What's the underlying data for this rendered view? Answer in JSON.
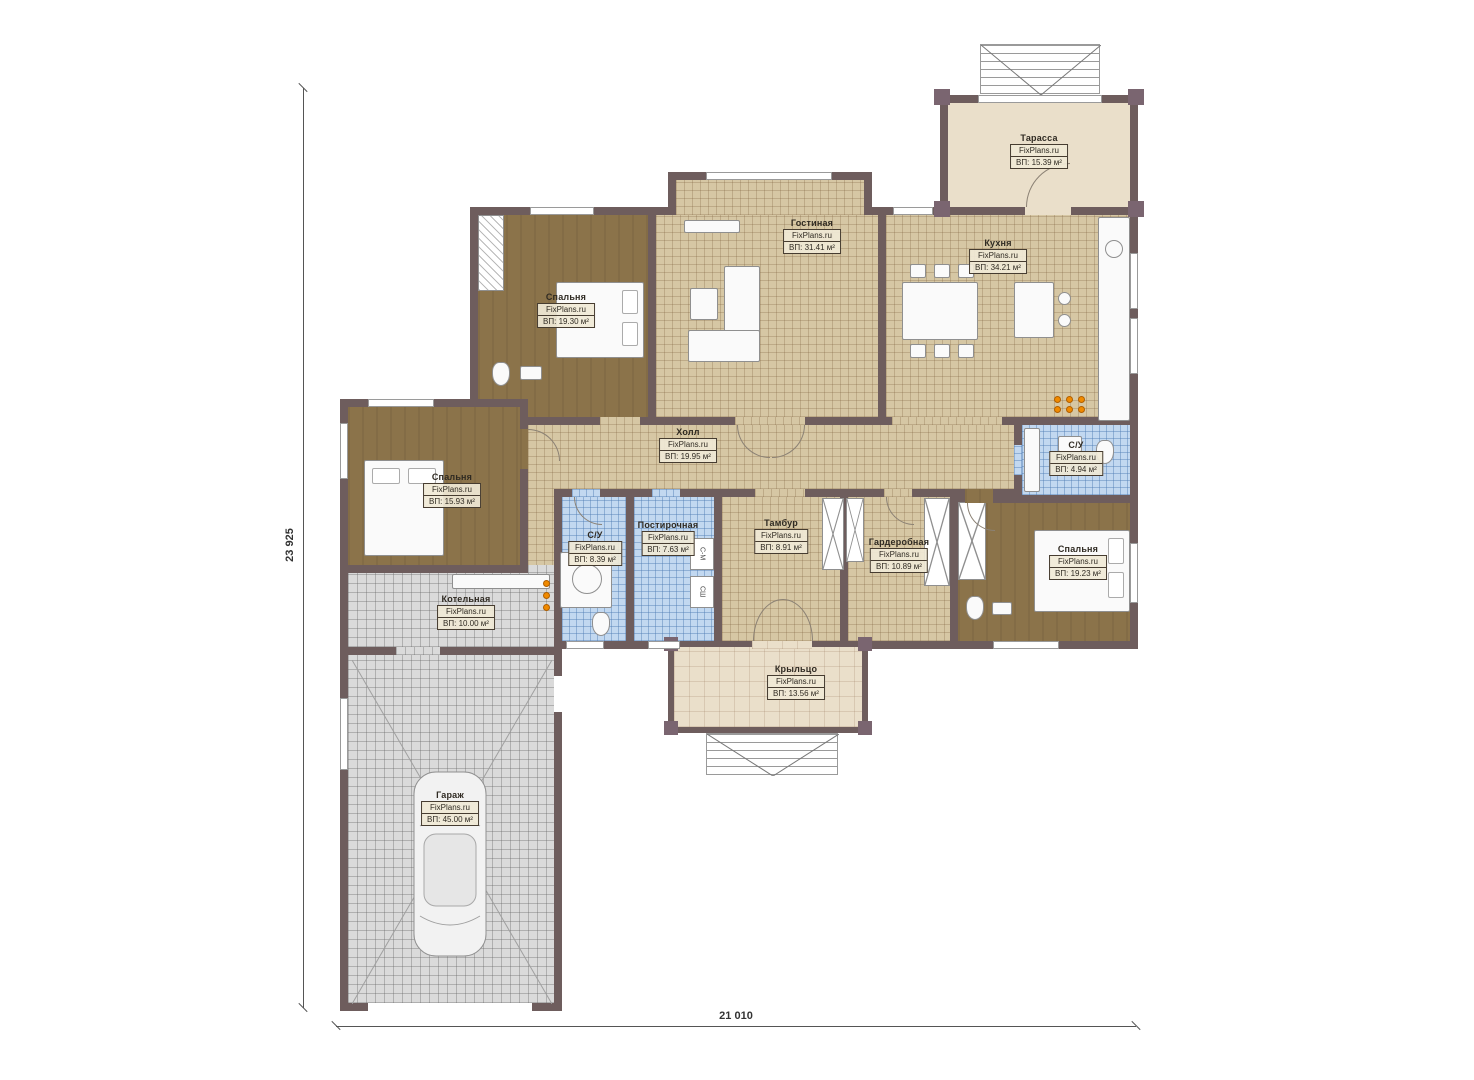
{
  "plan": {
    "watermark": "FixPlans.ru",
    "dim_width": "21 010",
    "dim_height": "23 925",
    "washer_label": "С-М",
    "dryer_label": "СШ",
    "colors": {
      "wall": "#6e5d5d",
      "tile_beige": "#d6c7a4",
      "floor_brown": "#8b734a",
      "tile_blue": "#c2d8f0",
      "tile_gray": "#dadada",
      "plain_beige": "#eadfca",
      "accent_orange": "#f08a00"
    }
  },
  "rooms": [
    {
      "id": "terrace",
      "name": "Тарасса",
      "area": "ВП: 15.39 м²"
    },
    {
      "id": "living",
      "name": "Гостиная",
      "area": "ВП: 31.41 м²"
    },
    {
      "id": "kitchen",
      "name": "Кухня",
      "area": "ВП: 34.21 м²"
    },
    {
      "id": "bedroom-top",
      "name": "Спальня",
      "area": "ВП: 19.30 м²"
    },
    {
      "id": "hall",
      "name": "Холл",
      "area": "ВП: 19.95 м²"
    },
    {
      "id": "bedroom-left",
      "name": "Спальня",
      "area": "ВП: 15.93 м²"
    },
    {
      "id": "bathroom-left",
      "name": "С/У",
      "area": "ВП: 8.39 м²"
    },
    {
      "id": "laundry",
      "name": "Постирочная",
      "area": "ВП: 7.63 м²"
    },
    {
      "id": "vestibule",
      "name": "Тамбур",
      "area": "ВП: 8.91 м²"
    },
    {
      "id": "wardrobe",
      "name": "Гардеробная",
      "area": "ВП: 10.89 м²"
    },
    {
      "id": "bathroom-right",
      "name": "С/У",
      "area": "ВП: 4.94 м²"
    },
    {
      "id": "bedroom-right",
      "name": "Спальня",
      "area": "ВП: 19.23 м²"
    },
    {
      "id": "boiler",
      "name": "Котельная",
      "area": "ВП: 10.00 м²"
    },
    {
      "id": "garage",
      "name": "Гараж",
      "area": "ВП: 45.00 м²"
    },
    {
      "id": "porch",
      "name": "Крыльцо",
      "area": "ВП: 13.56 м²"
    }
  ]
}
